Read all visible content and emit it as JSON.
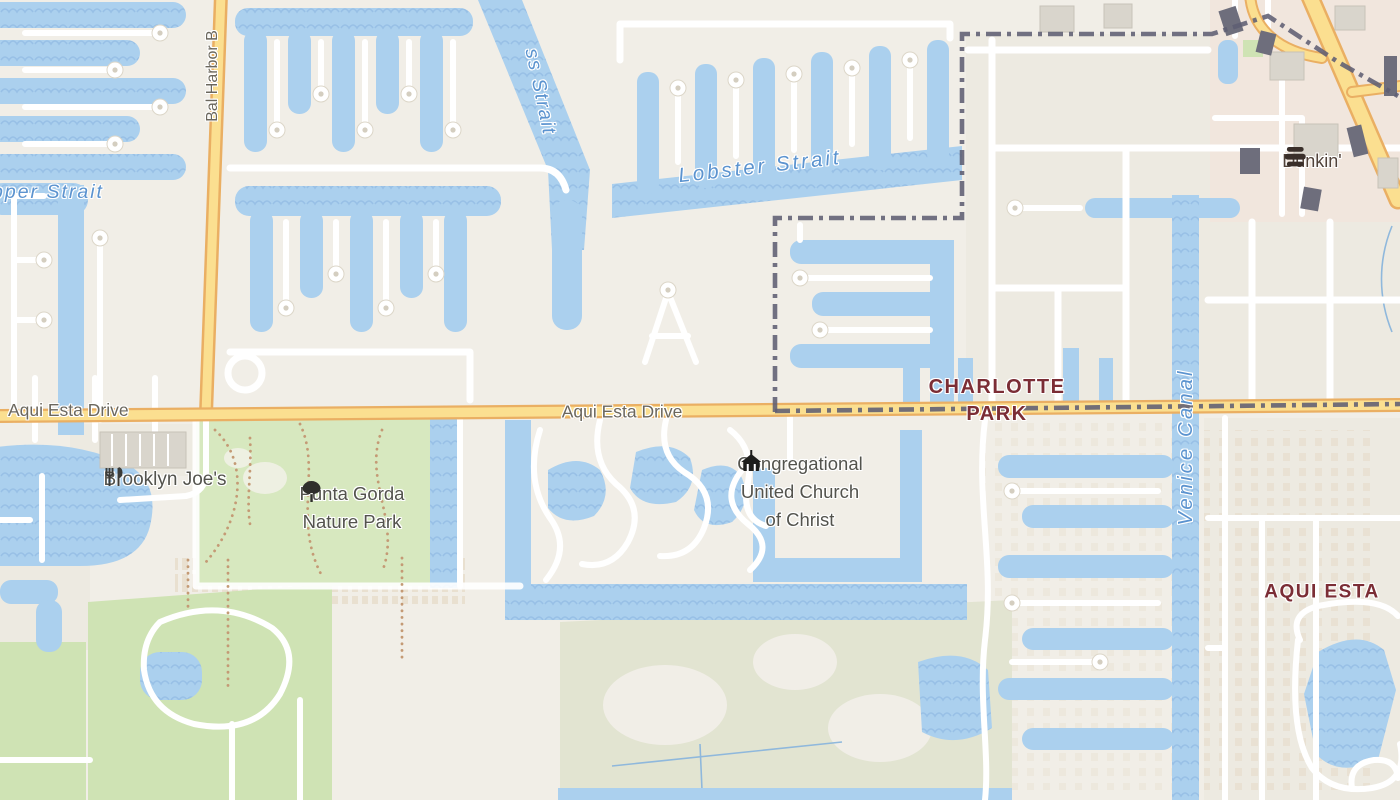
{
  "map": {
    "colors": {
      "land": "#f1eee7",
      "block": "#edeae1",
      "water": "#abd0ee",
      "water_wave": "#98c0e6",
      "road": "#ffffff",
      "road_casing": "#dcd6c8",
      "road_primary": "#fbdf90",
      "road_primary_casing": "#eaaf63",
      "park": "#d7e8bf",
      "golf": "#cfe3b4",
      "scrub": "#e2e4d1",
      "commercial": "#f1e6dd",
      "boundary": "#5e5e73",
      "building": "#d9d5cc",
      "building_dark": "#6e6e7c",
      "label_road": "#6b675d",
      "label_water": "#5b93cf",
      "label_place": "#7b2d35",
      "label_poi": "#53534d",
      "label_brand": "#514239"
    },
    "road_labels": [
      {
        "text": "Bal Harbor B"
      },
      {
        "text": "Aqui Esta Drive"
      },
      {
        "text": "Aqui Esta Drive"
      }
    ],
    "water_labels": [
      {
        "text": "pper Strait"
      },
      {
        "text": "ss Strait"
      },
      {
        "text": "Lobster Strait"
      },
      {
        "text": "Venice Canal"
      }
    ],
    "place_labels": {
      "charlotte_park": {
        "line1": "CHARLOTTE",
        "line2": "PARK"
      },
      "aqui_esta": {
        "text": "AQUI ESTA"
      }
    },
    "pois": {
      "dunkin": {
        "name": "Dunkin'",
        "icon": "donut-stack-icon"
      },
      "brooklyn_joes": {
        "name": "Brooklyn Joe's",
        "icon": "restaurant-icon"
      },
      "nature_park": {
        "line1": "Punta Gorda",
        "line2": "Nature Park",
        "icon": "tree-icon"
      },
      "church": {
        "line1": "Congregational",
        "line2": "United Church",
        "line3": "of Christ",
        "icon": "church-icon"
      }
    }
  }
}
